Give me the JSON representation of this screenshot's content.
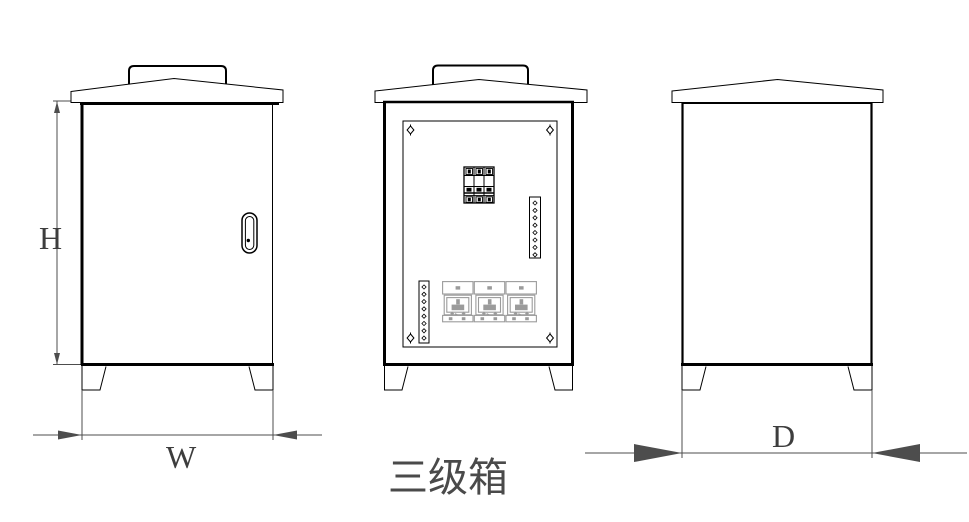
{
  "title": {
    "text": "三级箱"
  },
  "dimension_labels": {
    "height": "H",
    "width": "W",
    "depth": "D"
  },
  "colors": {
    "background": "#ffffff",
    "cabinet_line": "#000000",
    "dimension_line": "#4d4d4d",
    "label_text": "#3d3d3d",
    "title_text": "#4a4a4a",
    "socket_gray": "#9b9b9b"
  },
  "components": {
    "view_count": 3,
    "breaker_pole_count": 3,
    "socket_count": 3,
    "terminal_strip_count": 2,
    "terminal_dots_per_strip": 8,
    "panel_screw_count": 4,
    "legs_per_view": 2
  }
}
